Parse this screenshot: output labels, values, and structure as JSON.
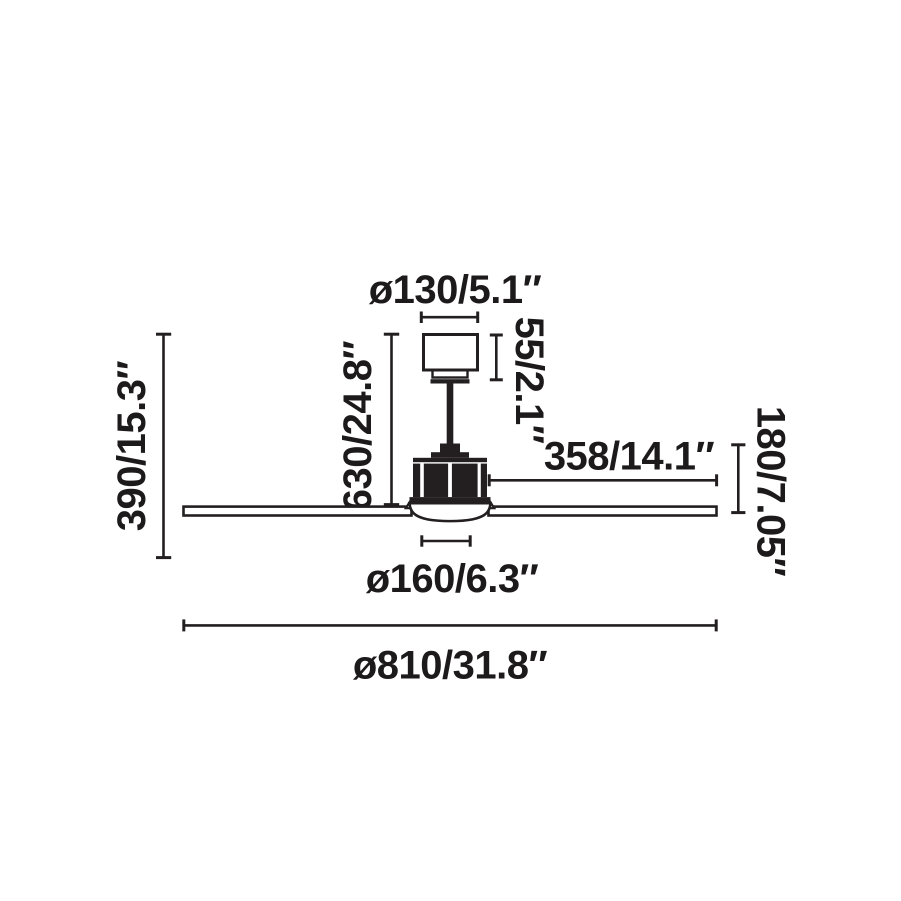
{
  "colors": {
    "ink": "#231f20",
    "background": "#ffffff"
  },
  "diagram": {
    "labels": {
      "canopy_diameter": "ø130/5.1″",
      "canopy_height": "55/2.1″",
      "drop_height": "630/24.8″",
      "total_height": "390/15.3″",
      "blade_length": "358/14.1″",
      "body_height": "180/7.05″",
      "light_diameter": "ø160/6.3″",
      "fan_diameter": "ø810/31.8″"
    }
  }
}
